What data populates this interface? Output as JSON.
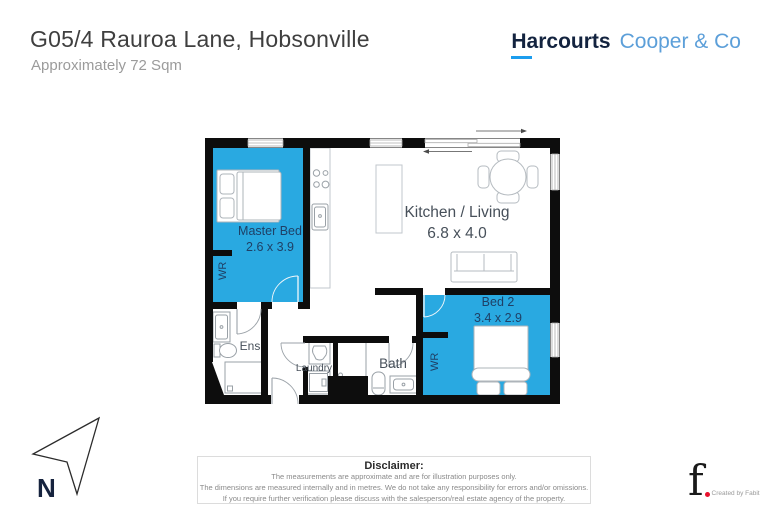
{
  "header": {
    "title": "G05/4 Rauroa Lane, Hobsonville",
    "subtitle": "Approximately  72 Sqm",
    "brand_primary": "Harcourts",
    "brand_secondary": "Cooper & Co"
  },
  "rooms": {
    "master": {
      "name": "Master Bed",
      "dims": "2.6 x 3.9"
    },
    "living": {
      "name": "Kitchen / Living",
      "dims": "6.8 x 4.0"
    },
    "bed2": {
      "name": "Bed 2",
      "dims": "3.4 x 2.9"
    },
    "ens": {
      "name": "Ens"
    },
    "laundry": {
      "name": "Laundry"
    },
    "bath": {
      "name": "Bath"
    },
    "wr_master": {
      "name": "WR"
    },
    "wr_bed2": {
      "name": "WR"
    }
  },
  "compass": {
    "north_label": "N"
  },
  "disclaimer": {
    "heading": "Disclaimer:",
    "lines": [
      "The measurements are approximate and are for illustration purposes only.",
      "The dimensions are measured internally and in metres. We do not take any responsibility for errors and/or omissions.",
      "If you require further verification please discuss with the salesperson/real estate agency of the property."
    ]
  },
  "credit": {
    "mark": "f",
    "caption": "Created by Fabit"
  },
  "colors": {
    "room_fill": "#29a9e1",
    "wall": "#0d0d0d",
    "brand_navy": "#13233f",
    "brand_light_blue": "#5c9fd9",
    "brand_underline": "#1c9dee",
    "credit_red": "#e8112d",
    "label_on_room": "#1f4066",
    "label_on_floor": "#4a525a"
  }
}
